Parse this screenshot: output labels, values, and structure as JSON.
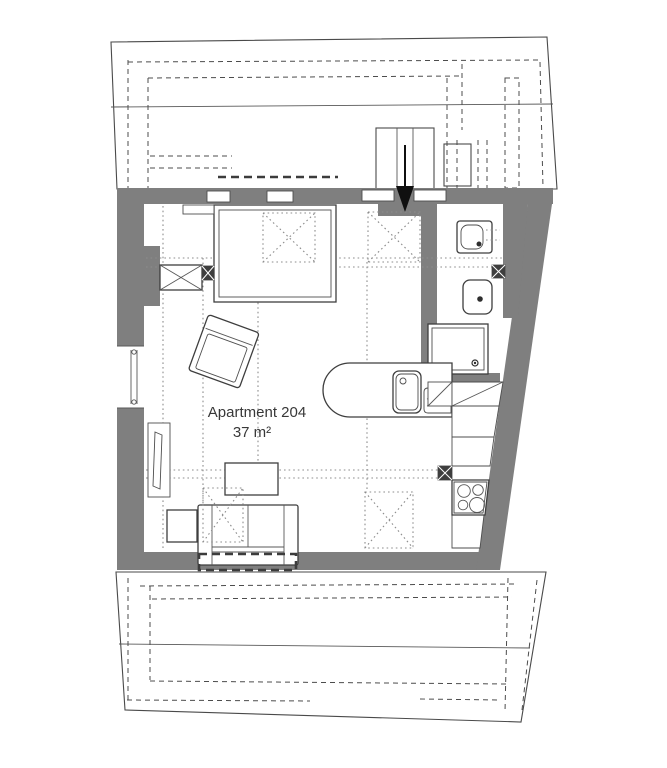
{
  "plan": {
    "label": {
      "name": "Apartment 204",
      "area": "37 m²"
    },
    "colors": {
      "wall": "#7f7f7f",
      "line": "#3e3e3e",
      "roof_stripe": "#6b6b6b",
      "entry_arrow": "#101010",
      "background": "#ffffff"
    },
    "fixtures": [
      "staircase",
      "entry-arrow",
      "bed",
      "wardrobe",
      "armchair",
      "tv-panel",
      "window",
      "coffee-table",
      "side-table",
      "sofa",
      "kitchen-counter",
      "kitchen-sink",
      "dish-drainer",
      "stove",
      "kitchen-cabinets",
      "toilet",
      "washbasin",
      "shower",
      "skylight-markers",
      "upper-roof",
      "lower-roof"
    ]
  }
}
